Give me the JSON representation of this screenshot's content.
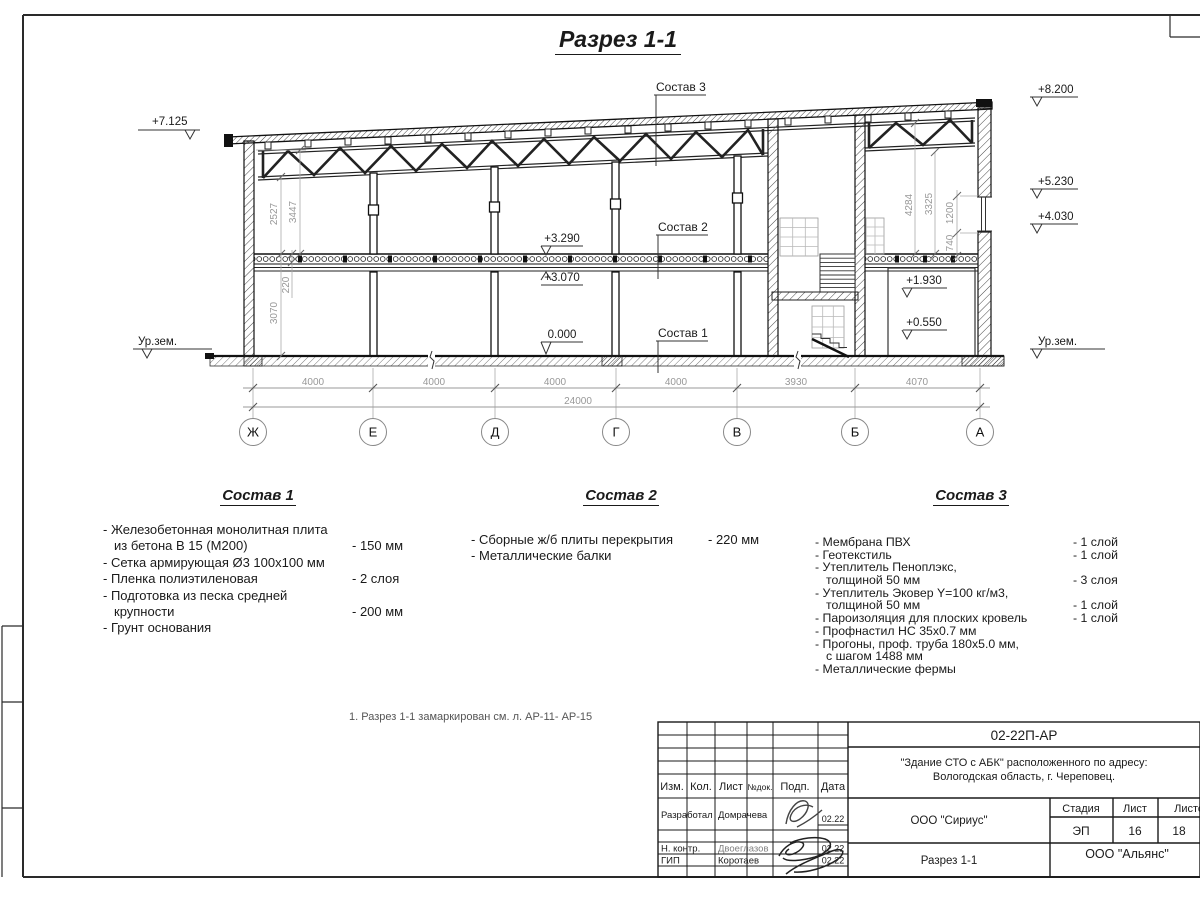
{
  "sheet": {
    "title": "Разрез 1-1",
    "note": "1. Разрез 1-1 замаркирован см. л. АР-11- АР-15"
  },
  "colors": {
    "line": "#1a1a1a",
    "dim_text": "#989898",
    "thin_line": "#aaaaaa"
  },
  "drawing": {
    "elev_left_top": "+7.125",
    "elev_ground_left": "Ур.зем.",
    "elev_right_top": "+8.200",
    "elev_right_1": "+5.230",
    "elev_right_2": "+4.030",
    "elev_ground_right": "Ур.зем.",
    "elev_slab_top": "+3.290",
    "elev_slab_bot": "+3.070",
    "elev_floor": "0.000",
    "elev_mezz_1": "+1.930",
    "elev_mezz_2": "+0.550",
    "leader_1": "Состав 1",
    "leader_2": "Состав 2",
    "leader_3": "Состав 3",
    "vdim_2527": "2527",
    "vdim_3447": "3447",
    "vdim_220": "220",
    "vdim_3070": "3070",
    "vdim_4284": "4284",
    "vdim_3325": "3325",
    "vdim_1200": "1200",
    "vdim_740": "740",
    "hdims": [
      "4000",
      "4000",
      "4000",
      "4000",
      "3930",
      "4070"
    ],
    "hdim_total": "24000",
    "axes": [
      "Ж",
      "Е",
      "Д",
      "Г",
      "В",
      "Б",
      "А"
    ]
  },
  "comp1": {
    "title": "Состав 1",
    "rows": [
      {
        "t": "- Железобетонная  монолитная плита",
        "v": ""
      },
      {
        "t": "из бетона В 15 (М200)",
        "v": "- 150 мм"
      },
      {
        "t": "- Сетка армирующая Ø3 100х100 мм",
        "v": ""
      },
      {
        "t": "- Пленка полиэтиленовая",
        "v": "-  2 слоя"
      },
      {
        "t": "- Подготовка из песка средней",
        "v": ""
      },
      {
        "t": "крупности",
        "v": "- 200 мм"
      },
      {
        "t": "- Грунт основания",
        "v": ""
      }
    ]
  },
  "comp2": {
    "title": "Состав 2",
    "rows": [
      {
        "t": "- Сборные ж/б плиты перекрытия",
        "v": "- 220 мм"
      },
      {
        "t": "- Металлические балки",
        "v": ""
      }
    ]
  },
  "comp3": {
    "title": "Состав 3",
    "rows": [
      {
        "t": "- Мембрана ПВХ",
        "v": "- 1 слой"
      },
      {
        "t": "- Геотекстиль",
        "v": "- 1 слой"
      },
      {
        "t": "- Утеплитель Пеноплэкс,",
        "v": ""
      },
      {
        "t": "толщиной 50 мм",
        "v": "- 3 слоя"
      },
      {
        "t": "- Утеплитель Эковер Y=100 кг/м3,",
        "v": ""
      },
      {
        "t": "толщиной 50 мм",
        "v": "- 1 слой"
      },
      {
        "t": "- Пароизоляция для плоских кровель",
        "v": "- 1 слой"
      },
      {
        "t": "- Профнастил НС 35х0.7 мм",
        "v": ""
      },
      {
        "t": "- Прогоны, проф. труба 180х5.0 мм,",
        "v": ""
      },
      {
        "t": "с шагом 1488 мм",
        "v": ""
      },
      {
        "t": "- Металлические фермы",
        "v": ""
      }
    ]
  },
  "titleblock": {
    "doc_number": "02-22П-АР",
    "project_line1": "\"Здание СТО с АБК\" расположенного по адресу:",
    "project_line2": "Вологодская область, г. Череповец.",
    "designer_org": "ООО \"Сириус\"",
    "sheet_name": "Разрез 1-1",
    "client_org": "ООО \"Альянс\"",
    "col_izm": "Изм.",
    "col_kol": "Кол.",
    "col_list": "Лист",
    "col_ndok": "№док.",
    "col_podp": "Подп.",
    "col_data": "Дата",
    "stage_label": "Стадия",
    "sheet_label": "Лист",
    "sheets_label": "Листов",
    "stage": "ЭП",
    "sheet_no": "16",
    "sheets_total": "18",
    "rows": [
      {
        "role": "Разработал",
        "name": "Домрачева",
        "date": "02.22"
      },
      {
        "role": "Н. контр.",
        "name": "Двоеглазов",
        "date": "02.22"
      },
      {
        "role": "ГИП",
        "name": "Коротаев",
        "date": "02.22"
      }
    ]
  }
}
